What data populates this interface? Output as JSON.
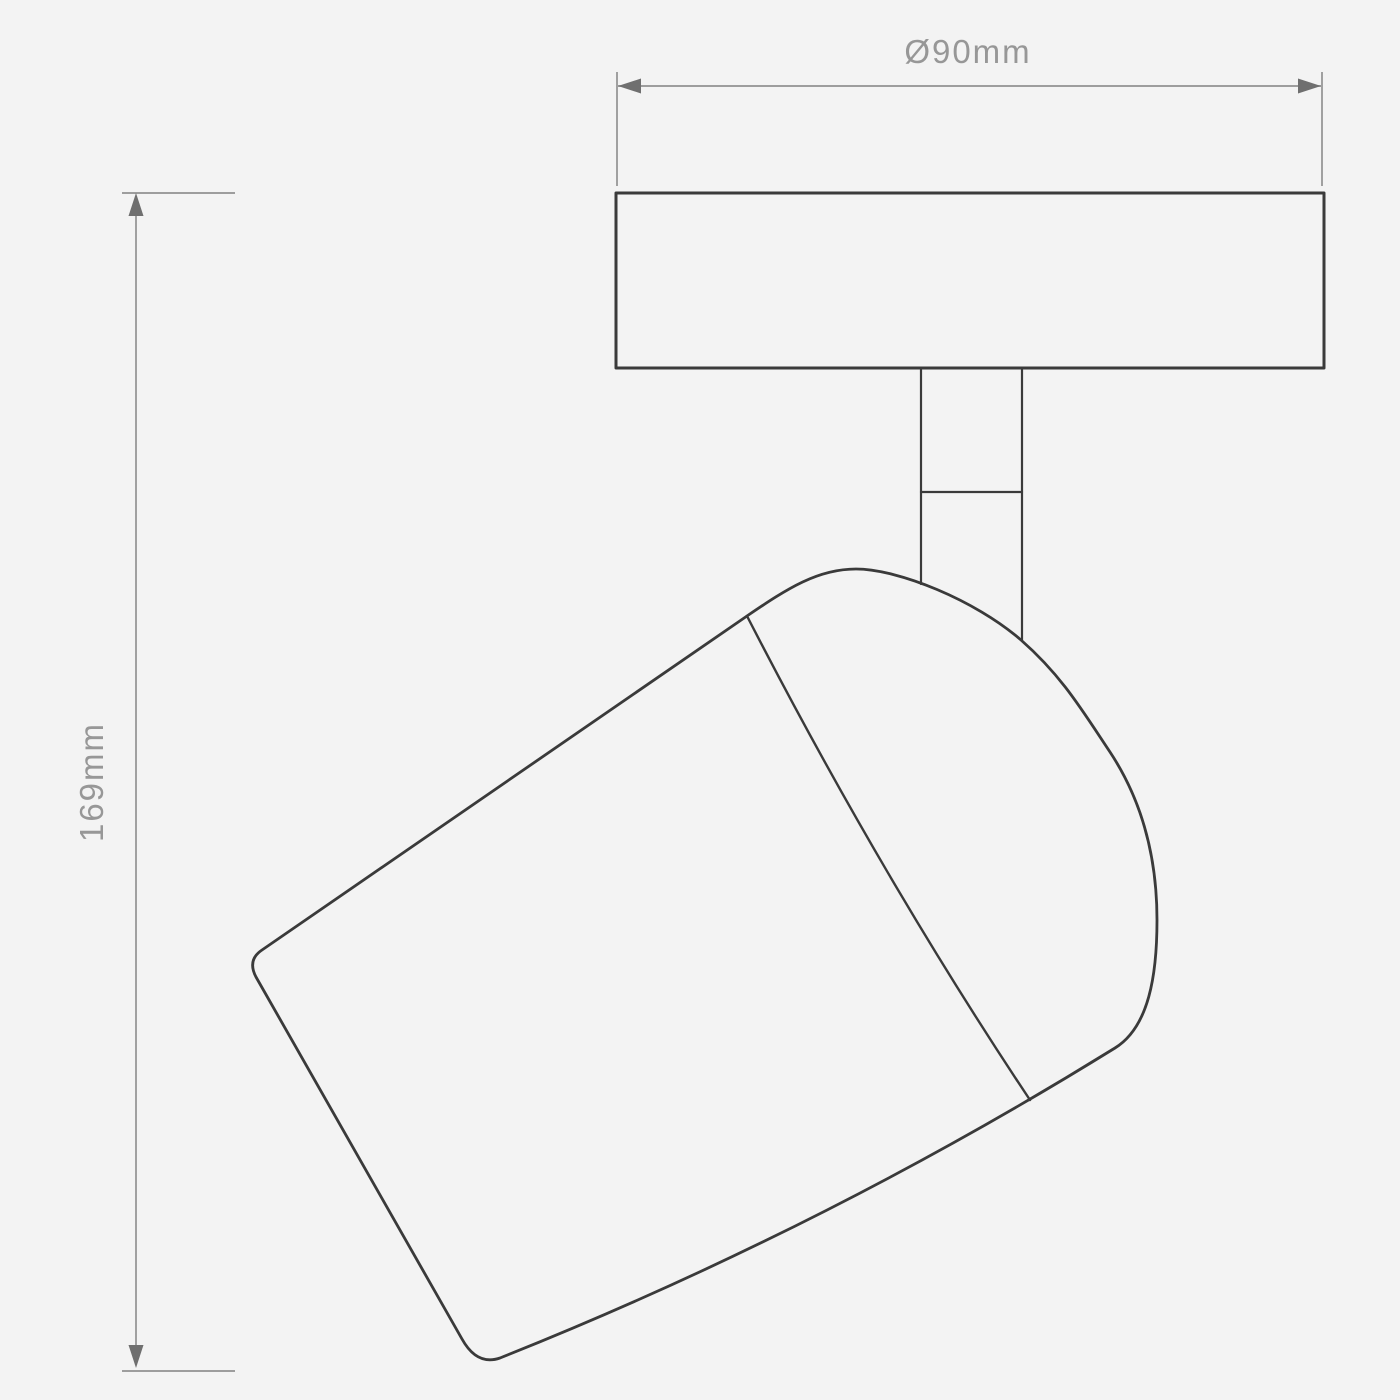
{
  "drawing": {
    "dimensions": {
      "width_label": "Ø90mm",
      "height_label": "169mm"
    },
    "colors": {
      "background": "#f3f3f3",
      "outline": "#3a3a3a",
      "dimension_line": "#919191",
      "arrow": "#6f6f6f",
      "label_text": "#979797"
    }
  }
}
